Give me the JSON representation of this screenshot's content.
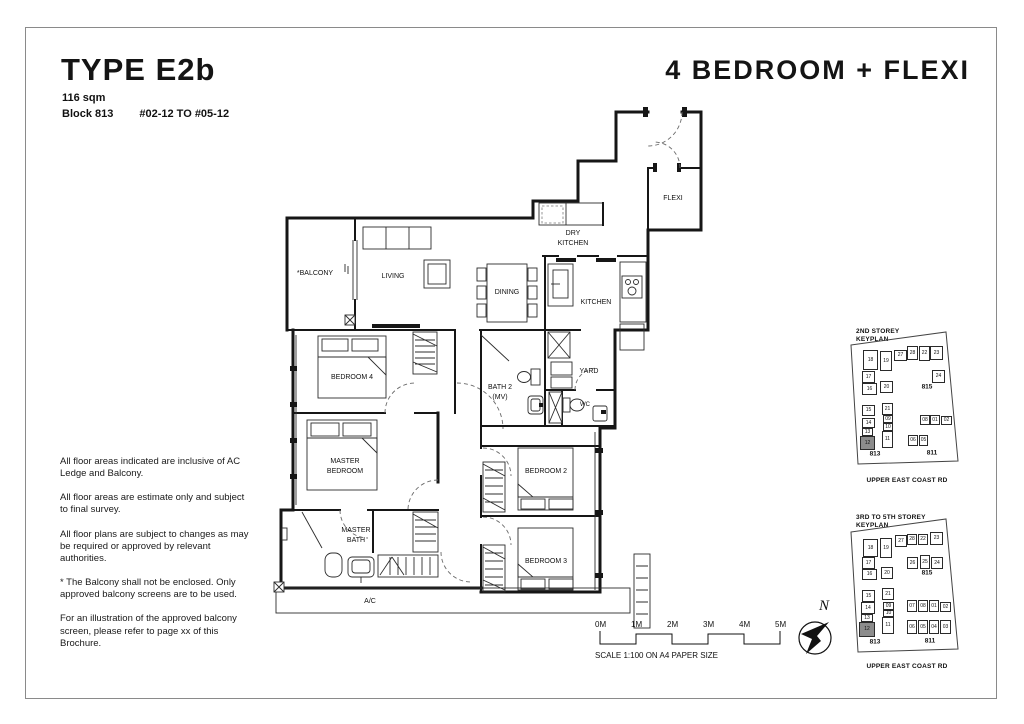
{
  "page": {
    "type_title": "TYPE E2b",
    "area": "116 sqm",
    "block": "Block 813",
    "units_range": "#02-12 TO #05-12",
    "category_title": "4 BEDROOM + FLEXI"
  },
  "disclaimer": {
    "p1": "All floor areas indicated are inclusive of AC Ledge and Balcony.",
    "p2": "All floor areas are estimate only and subject to final survey.",
    "p3": "All floor plans are subject to changes as may be required or approved by relevant authorities.",
    "p4": "* The Balcony shall not be enclosed. Only approved balcony screens are to be used.",
    "p5": "For an illustration of the approved balcony screen, please refer to page xx of this Brochure."
  },
  "plan": {
    "balcony": "*BALCONY",
    "living": "LIVING",
    "dining": "DINING",
    "dry_kitchen_1": "DRY",
    "dry_kitchen_2": "KITCHEN",
    "kitchen": "KITCHEN",
    "flexi": "FLEXI",
    "bedroom4": "BEDROOM 4",
    "bath2_1": "BATH 2",
    "bath2_2": "(MV)",
    "yard": "YARD",
    "wc": "WC",
    "master_1": "MASTER",
    "master_2": "BEDROOM",
    "bedroom2": "BEDROOM 2",
    "masterbath_1": "MASTER",
    "masterbath_2": "BATH",
    "bedroom3": "BEDROOM 3",
    "ac": "A/C"
  },
  "scale_bar": {
    "ticks": [
      "0M",
      "1M",
      "2M",
      "3M",
      "4M",
      "5M"
    ],
    "caption": "SCALE  1:100 ON A4 PAPER SIZE"
  },
  "compass": {
    "north_label": "N"
  },
  "keyplans": [
    {
      "title": "2ND STOREY\nKEYPLAN",
      "road": "UPPER EAST COAST RD",
      "blocks": [
        {
          "label": "815",
          "x": 79,
          "y": 61
        },
        {
          "label": "813",
          "x": 27,
          "y": 128
        },
        {
          "label": "811",
          "x": 84,
          "y": 127
        }
      ],
      "units": [
        {
          "n": "18",
          "x": 15,
          "y": 24,
          "w": 15,
          "h": 20,
          "dark": false
        },
        {
          "n": "19",
          "x": 32,
          "y": 25,
          "w": 12,
          "h": 20,
          "dark": false
        },
        {
          "n": "27",
          "x": 46,
          "y": 24,
          "w": 13,
          "h": 11,
          "dark": false
        },
        {
          "n": "28",
          "x": 59,
          "y": 20,
          "w": 11,
          "h": 14,
          "dark": false
        },
        {
          "n": "22",
          "x": 71,
          "y": 20,
          "w": 11,
          "h": 15,
          "dark": false
        },
        {
          "n": "23",
          "x": 82,
          "y": 20,
          "w": 13,
          "h": 14,
          "dark": false
        },
        {
          "n": "17",
          "x": 14,
          "y": 45,
          "w": 13,
          "h": 12,
          "dark": false
        },
        {
          "n": "24",
          "x": 84,
          "y": 44,
          "w": 13,
          "h": 13,
          "dark": false
        },
        {
          "n": "16",
          "x": 14,
          "y": 57,
          "w": 15,
          "h": 12,
          "dark": false
        },
        {
          "n": "20",
          "x": 32,
          "y": 55,
          "w": 13,
          "h": 12,
          "dark": false
        },
        {
          "n": "15",
          "x": 14,
          "y": 79,
          "w": 13,
          "h": 11,
          "dark": false
        },
        {
          "n": "21",
          "x": 34,
          "y": 77,
          "w": 11,
          "h": 12,
          "dark": false
        },
        {
          "n": "14",
          "x": 14,
          "y": 92,
          "w": 13,
          "h": 10,
          "dark": false
        },
        {
          "n": "09",
          "x": 35,
          "y": 89,
          "w": 10,
          "h": 8,
          "dark": false
        },
        {
          "n": "10",
          "x": 35,
          "y": 97,
          "w": 10,
          "h": 8,
          "dark": false
        },
        {
          "n": "08",
          "x": 72,
          "y": 89,
          "w": 10,
          "h": 10,
          "dark": false
        },
        {
          "n": "01",
          "x": 82,
          "y": 89,
          "w": 10,
          "h": 10,
          "dark": false
        },
        {
          "n": "02",
          "x": 93,
          "y": 90,
          "w": 11,
          "h": 9,
          "dark": false
        },
        {
          "n": "13",
          "x": 14,
          "y": 102,
          "w": 11,
          "h": 8,
          "dark": false
        },
        {
          "n": "12",
          "x": 12,
          "y": 110,
          "w": 15,
          "h": 14,
          "dark": true
        },
        {
          "n": "11",
          "x": 34,
          "y": 105,
          "w": 11,
          "h": 17,
          "dark": false
        },
        {
          "n": "06",
          "x": 60,
          "y": 109,
          "w": 10,
          "h": 11,
          "dark": false
        },
        {
          "n": "05",
          "x": 71,
          "y": 109,
          "w": 9,
          "h": 11,
          "dark": false
        }
      ]
    },
    {
      "title": "3RD TO 5TH STOREY\nKEYPLAN",
      "road": "UPPER EAST COAST RD",
      "blocks": [
        {
          "label": "815",
          "x": 79,
          "y": 61
        },
        {
          "label": "813",
          "x": 27,
          "y": 130
        },
        {
          "label": "811",
          "x": 82,
          "y": 129
        }
      ],
      "units": [
        {
          "n": "18",
          "x": 15,
          "y": 27,
          "w": 15,
          "h": 18,
          "dark": false
        },
        {
          "n": "19",
          "x": 32,
          "y": 26,
          "w": 12,
          "h": 20,
          "dark": false
        },
        {
          "n": "27",
          "x": 47,
          "y": 23,
          "w": 12,
          "h": 12,
          "dark": false
        },
        {
          "n": "28",
          "x": 59,
          "y": 22,
          "w": 10,
          "h": 11,
          "dark": false
        },
        {
          "n": "22",
          "x": 70,
          "y": 22,
          "w": 10,
          "h": 11,
          "dark": false
        },
        {
          "n": "23",
          "x": 82,
          "y": 20,
          "w": 13,
          "h": 13,
          "dark": false
        },
        {
          "n": "17",
          "x": 14,
          "y": 45,
          "w": 13,
          "h": 12,
          "dark": false
        },
        {
          "n": "26",
          "x": 59,
          "y": 45,
          "w": 11,
          "h": 12,
          "dark": false
        },
        {
          "n": "25",
          "x": 72,
          "y": 43,
          "w": 10,
          "h": 14,
          "dark": false
        },
        {
          "n": "24",
          "x": 83,
          "y": 45,
          "w": 12,
          "h": 12,
          "dark": false
        },
        {
          "n": "16",
          "x": 14,
          "y": 57,
          "w": 15,
          "h": 11,
          "dark": false
        },
        {
          "n": "20",
          "x": 33,
          "y": 55,
          "w": 12,
          "h": 12,
          "dark": false
        },
        {
          "n": "15",
          "x": 14,
          "y": 78,
          "w": 13,
          "h": 12,
          "dark": false
        },
        {
          "n": "21",
          "x": 34,
          "y": 76,
          "w": 12,
          "h": 12,
          "dark": false
        },
        {
          "n": "14",
          "x": 13,
          "y": 90,
          "w": 14,
          "h": 12,
          "dark": false
        },
        {
          "n": "09",
          "x": 35,
          "y": 90,
          "w": 11,
          "h": 8,
          "dark": false
        },
        {
          "n": "10",
          "x": 35,
          "y": 98,
          "w": 11,
          "h": 7,
          "dark": false
        },
        {
          "n": "07",
          "x": 59,
          "y": 88,
          "w": 10,
          "h": 12,
          "dark": false
        },
        {
          "n": "08",
          "x": 70,
          "y": 88,
          "w": 10,
          "h": 12,
          "dark": false
        },
        {
          "n": "01",
          "x": 81,
          "y": 88,
          "w": 10,
          "h": 12,
          "dark": false
        },
        {
          "n": "02",
          "x": 92,
          "y": 90,
          "w": 11,
          "h": 10,
          "dark": false
        },
        {
          "n": "13",
          "x": 13,
          "y": 102,
          "w": 12,
          "h": 8,
          "dark": false
        },
        {
          "n": "12",
          "x": 11,
          "y": 110,
          "w": 16,
          "h": 15,
          "dark": true
        },
        {
          "n": "11",
          "x": 34,
          "y": 105,
          "w": 12,
          "h": 17,
          "dark": false
        },
        {
          "n": "06",
          "x": 59,
          "y": 108,
          "w": 10,
          "h": 14,
          "dark": false
        },
        {
          "n": "05",
          "x": 70,
          "y": 108,
          "w": 10,
          "h": 14,
          "dark": false
        },
        {
          "n": "04",
          "x": 81,
          "y": 108,
          "w": 10,
          "h": 14,
          "dark": false
        },
        {
          "n": "03",
          "x": 92,
          "y": 108,
          "w": 11,
          "h": 14,
          "dark": false
        }
      ]
    }
  ]
}
